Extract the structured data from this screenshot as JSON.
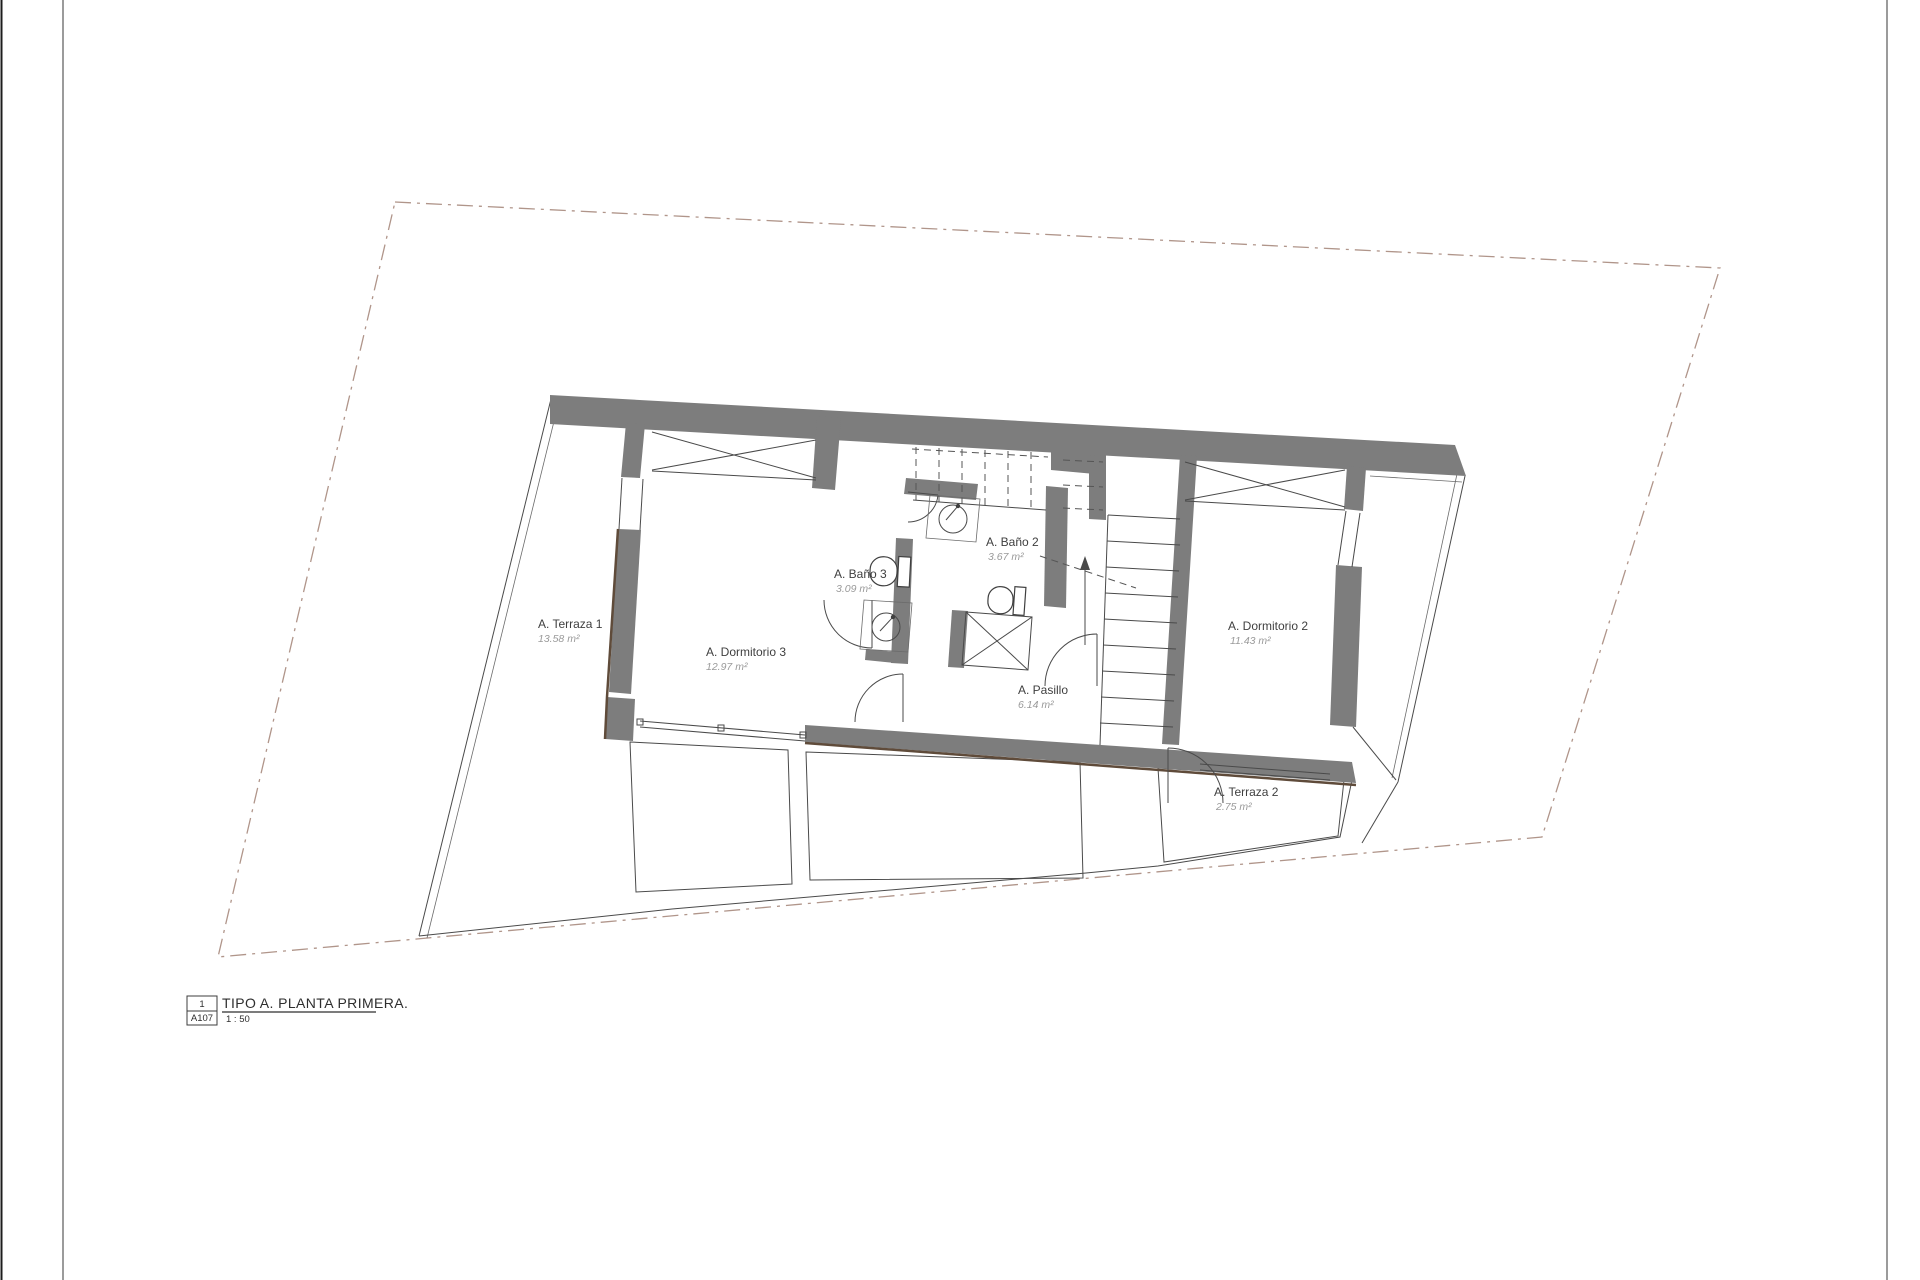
{
  "document": {
    "kind": "architectural-floor-plan",
    "background": "#ffffff"
  },
  "title_block": {
    "detail_number": "1",
    "sheet_code": "A107",
    "title": "TIPO A. PLANTA PRIMERA.",
    "scale": "1 : 50"
  },
  "rooms": [
    {
      "id": "terraza-1",
      "name": "A. Terraza 1",
      "area": "13.58 m²"
    },
    {
      "id": "dormitorio-3",
      "name": "A. Dormitorio 3",
      "area": "12.97 m²"
    },
    {
      "id": "bano-3",
      "name": "A. Baño 3",
      "area": "3.09 m²"
    },
    {
      "id": "bano-2",
      "name": "A. Baño 2",
      "area": "3.67 m²"
    },
    {
      "id": "pasillo",
      "name": "A. Pasillo",
      "area": "6.14 m²"
    },
    {
      "id": "dormitorio-2",
      "name": "A. Dormitorio 2",
      "area": "11.43 m²"
    },
    {
      "id": "terraza-2",
      "name": "A. Terraza 2",
      "area": "2.75 m²"
    }
  ],
  "colors": {
    "wall": "#7d7d7d",
    "wall_accent": "#5f4b3a",
    "line": "#4a4a4a",
    "site_boundary": "#b0958a",
    "room_name_text": "#3f3f3f",
    "room_area_text": "#9a9a9a"
  }
}
